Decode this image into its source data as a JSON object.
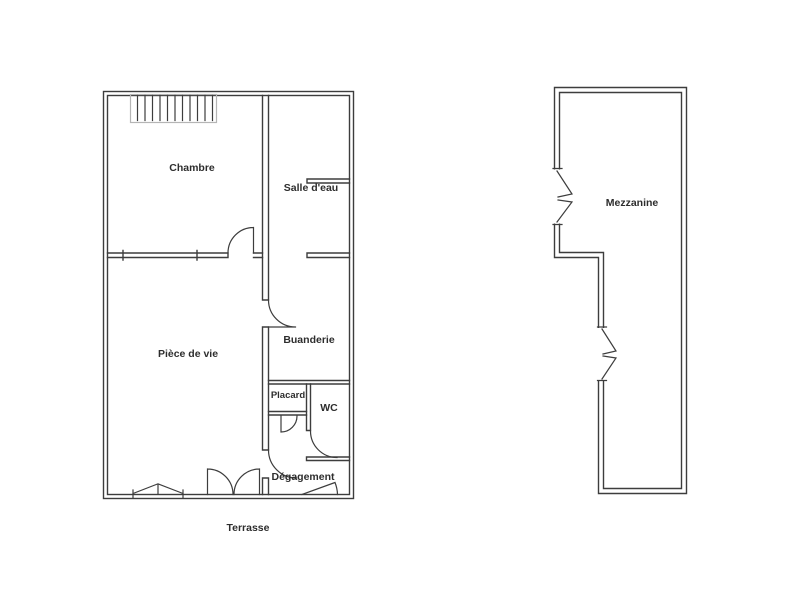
{
  "colors": {
    "background": "#ffffff",
    "wall": "#3d3d3d",
    "stairs_hatch_frame": "#b5b5b5",
    "text": "#2d2d2d"
  },
  "ground_floor": {
    "rooms": {
      "chambre": "Chambre",
      "salle_deau": "Salle d'eau",
      "piece_de_vie": "Pièce de vie",
      "buanderie": "Buanderie",
      "placard": "Placard",
      "wc": "WC",
      "degagement": "Dégagement",
      "terrasse": "Terrasse"
    }
  },
  "upper_floor": {
    "rooms": {
      "mezzanine": "Mezzanine"
    }
  }
}
